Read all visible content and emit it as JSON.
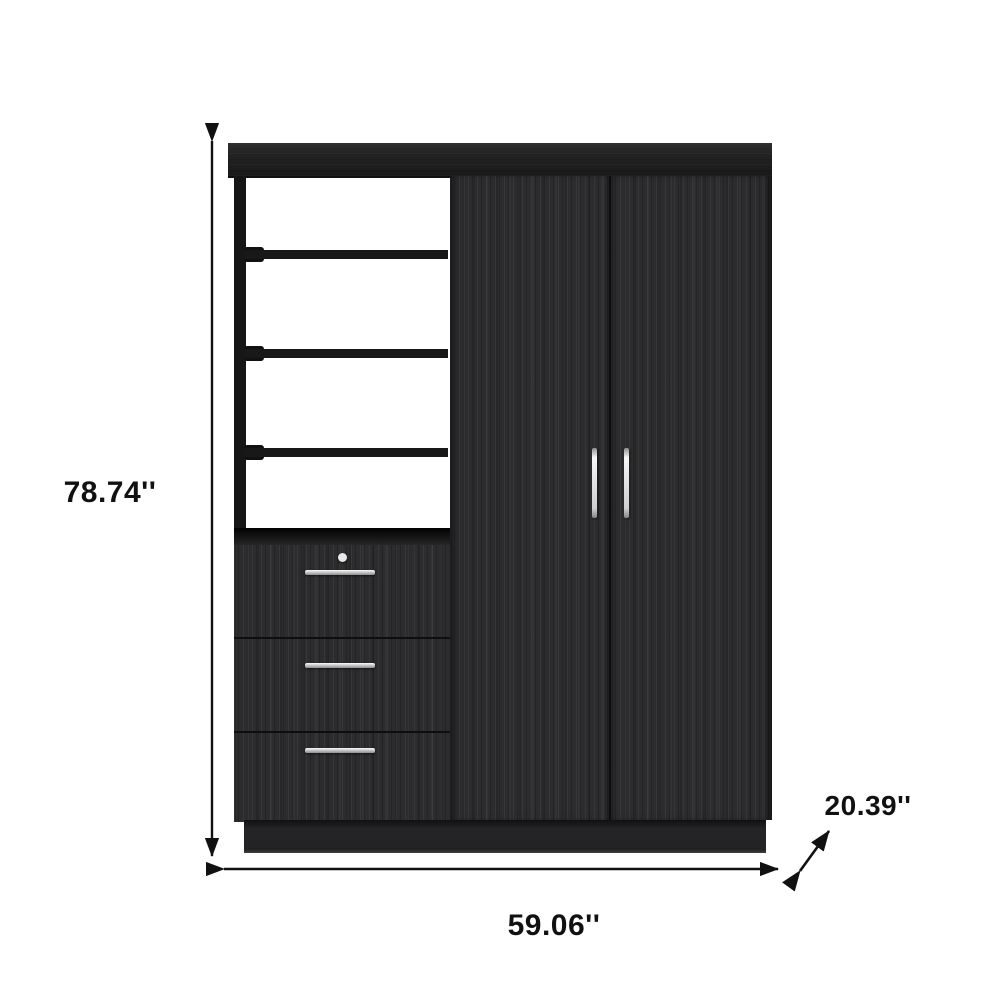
{
  "annotations": {
    "height": {
      "label": "78.74''",
      "icon": "vertical-double-arrow-icon"
    },
    "width": {
      "label": "59.06''",
      "icon": "horizontal-double-arrow-icon"
    },
    "depth": {
      "label": "20.39''",
      "icon": "diagonal-double-arrow-icon"
    }
  },
  "furniture": {
    "type": "wardrobe",
    "finish_color": "#232325",
    "open_shelves": 3,
    "drawers": 3,
    "doors": 2,
    "drawer_knobs": 1,
    "handle_color": "#d9d9d9"
  },
  "colors": {
    "background": "#ffffff",
    "annotation": "#111111",
    "wood_dark": "#161616",
    "wood_face": "#2c2c2e",
    "handle_silver": "#d9d9d9"
  }
}
